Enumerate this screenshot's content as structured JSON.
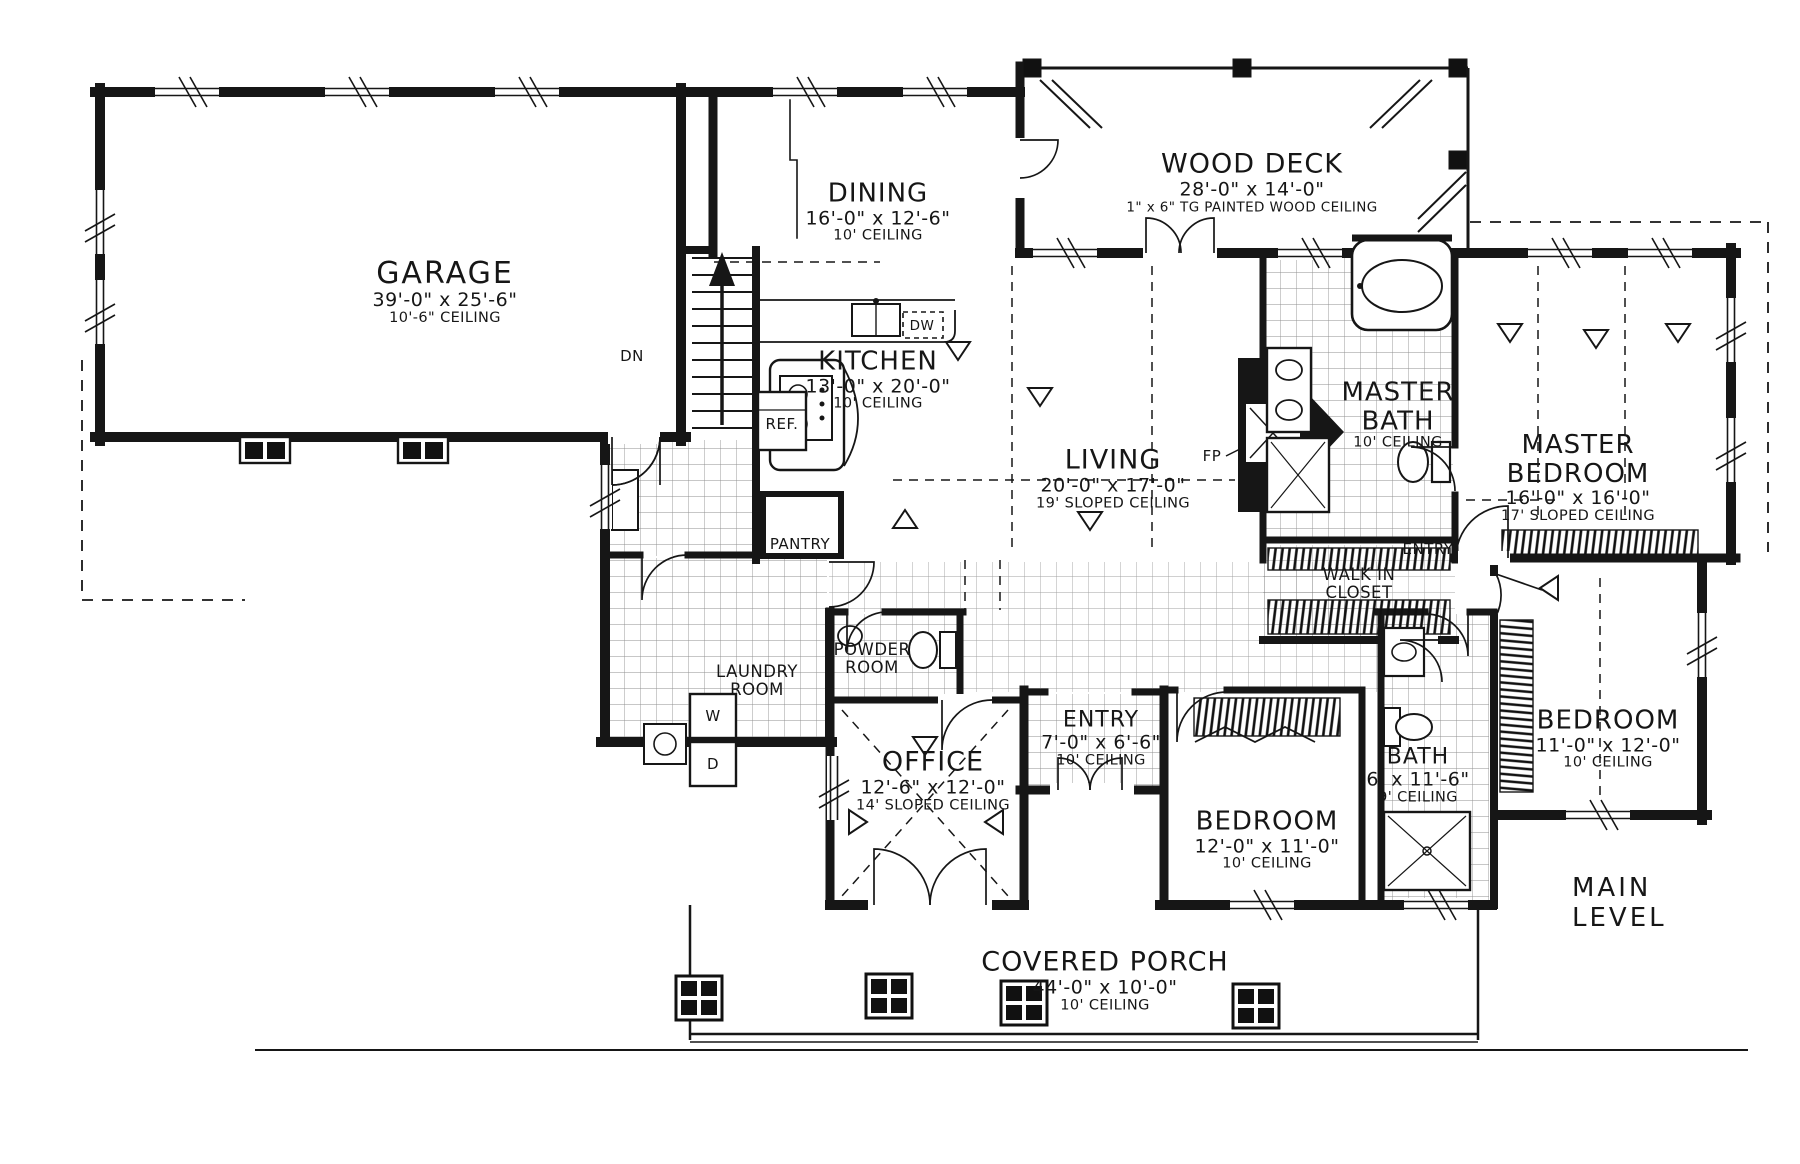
{
  "drawing": {
    "level_label": "MAIN LEVEL",
    "style": "hand-drawn architectural floor plan",
    "colors": {
      "ink": "#161616",
      "paper": "#ffffff"
    }
  },
  "rooms": [
    {
      "name": "GARAGE",
      "dims": "39'-0\" x 25'-6\"",
      "ceiling": "10'-6\" CEILING"
    },
    {
      "name": "DINING",
      "dims": "16'-0\" x 12'-6\"",
      "ceiling": "10' CEILING"
    },
    {
      "name": "WOOD DECK",
      "dims": "28'-0\" x 14'-0\"",
      "ceiling": "1\" x 6\" TG PAINTED WOOD CEILING"
    },
    {
      "name": "KITCHEN",
      "dims": "13'-0\" x 20'-0\"",
      "ceiling": "10' CEILING"
    },
    {
      "name": "LIVING",
      "dims": "20'-0\" x 17'-0\"",
      "ceiling": "19' SLOPED CEILING"
    },
    {
      "name": "MASTER BATH",
      "ceiling": "10' CEILING"
    },
    {
      "name": "MASTER BEDROOM",
      "dims": "16'-0\" x 16'-0\"",
      "ceiling": "17' SLOPED CEILING"
    },
    {
      "name": "WALK IN CLOSET"
    },
    {
      "name": "LAUNDRY ROOM"
    },
    {
      "name": "POWDER ROOM"
    },
    {
      "name": "OFFICE",
      "dims": "12'-6\" x 12'-0\"",
      "ceiling": "14' SLOPED CEILING"
    },
    {
      "name": "ENTRY",
      "dims": "7'-0\" x 6'-6\"",
      "ceiling": "10' CEILING"
    },
    {
      "name": "BEDROOM",
      "dims": "12'-0\" x 11'-0\"",
      "ceiling": "10' CEILING"
    },
    {
      "name": "BATH",
      "dims": "6' x 11'-6\"",
      "ceiling": "9' CEILING"
    },
    {
      "name": "BEDROOM",
      "dims": "11'-0\" x 12'-0\"",
      "ceiling": "10' CEILING"
    },
    {
      "name": "COVERED PORCH",
      "dims": "44'-0\" x 10'-0\"",
      "ceiling": "10' CEILING"
    }
  ],
  "small_labels": {
    "dn": "DN",
    "ref": "REF.",
    "pantry": "PANTRY",
    "dw": "DW",
    "washer": "W",
    "dryer": "D",
    "fireplace": "FP",
    "entry_hall": "ENTRY"
  }
}
